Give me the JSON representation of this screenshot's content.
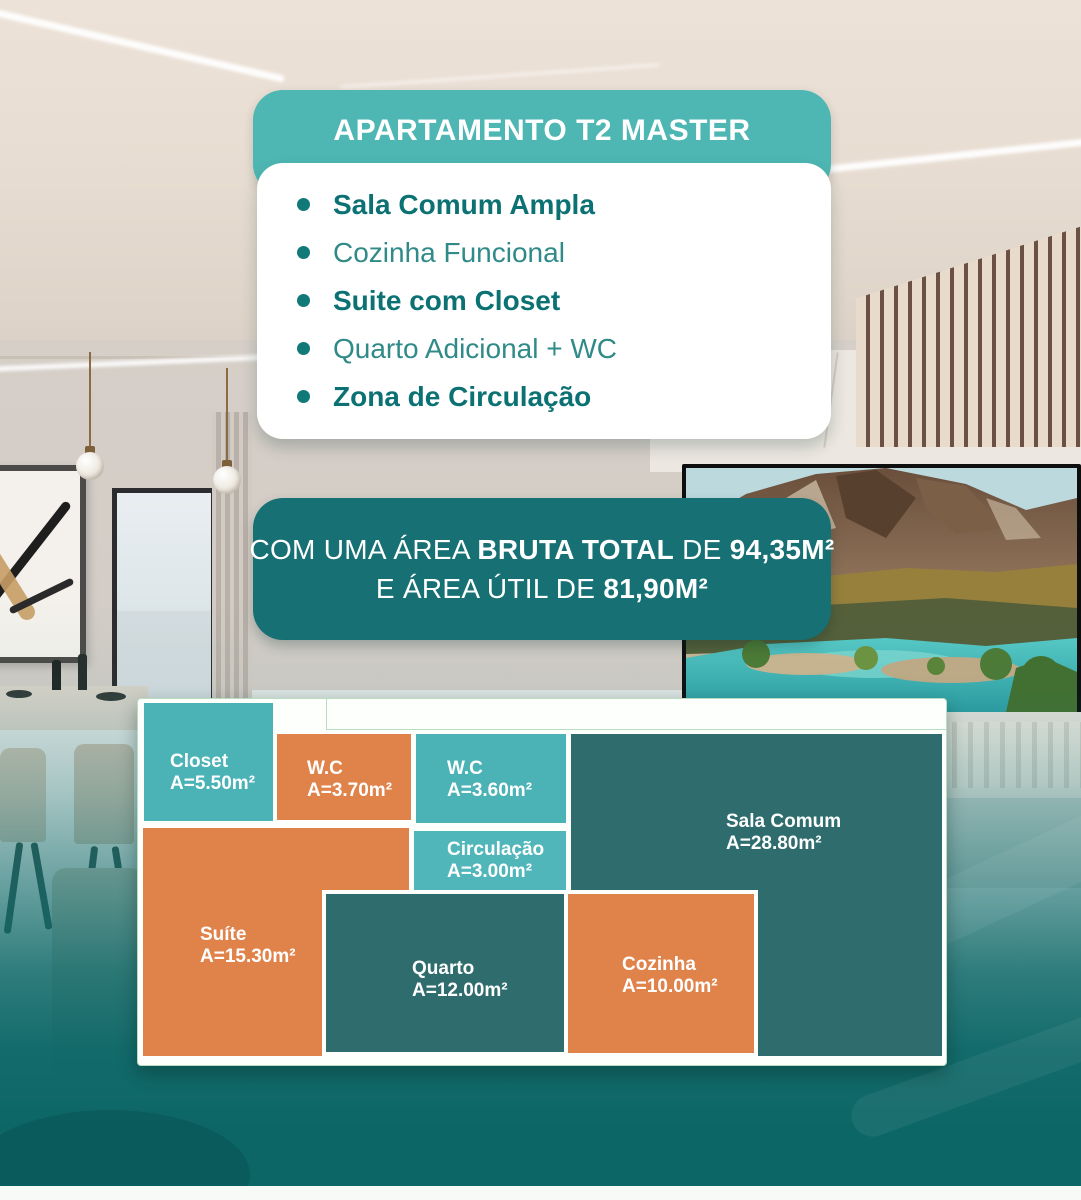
{
  "header": {
    "title": "APARTAMENTO T2 MASTER"
  },
  "features": {
    "items": [
      {
        "label": "Sala Comum Ampla",
        "emphasis": "bold"
      },
      {
        "label": "Cozinha Funcional",
        "emphasis": "regular"
      },
      {
        "label": "Suite com Closet",
        "emphasis": "bold"
      },
      {
        "label": "Quarto Adicional + WC",
        "emphasis": "regular"
      },
      {
        "label": "Zona de Circulação",
        "emphasis": "bold"
      }
    ]
  },
  "area_summary": {
    "line1": [
      {
        "text": "COM UMA ÁREA ",
        "bold": false
      },
      {
        "text": "BRUTA TOTAL",
        "bold": true
      },
      {
        "text": " DE ",
        "bold": false
      },
      {
        "text": "94,35M²",
        "bold": true
      }
    ],
    "line2": [
      {
        "text": "E ÁREA ÚTIL DE ",
        "bold": false
      },
      {
        "text": "81,90M²",
        "bold": true
      }
    ]
  },
  "floor_plan": {
    "rooms": [
      {
        "id": "closet",
        "name": "Closet",
        "area_label": "A=5.50m²",
        "area_m2": 5.5,
        "color": "#4bb2b6",
        "x": 6,
        "y": 4,
        "w": 129,
        "h": 118,
        "lx": 26,
        "ly": 48,
        "bordered": false
      },
      {
        "id": "wc-1",
        "name": "W.C",
        "area_label": "A=3.70m²",
        "area_m2": 3.7,
        "color": "#e0834b",
        "x": 139,
        "y": 35,
        "w": 134,
        "h": 86,
        "lx": 30,
        "ly": 24,
        "bordered": false
      },
      {
        "id": "wc-2",
        "name": "W.C",
        "area_label": "A=3.60m²",
        "area_m2": 3.6,
        "color": "#4bb2b6",
        "x": 278,
        "y": 35,
        "w": 150,
        "h": 89,
        "lx": 31,
        "ly": 24,
        "bordered": false
      },
      {
        "id": "circulacao",
        "name": "Circulação",
        "area_label": "A=3.00m²",
        "area_m2": 3.0,
        "color": "#50b6ba",
        "x": 276,
        "y": 132,
        "w": 152,
        "h": 59,
        "lx": 33,
        "ly": 8,
        "bordered": false
      },
      {
        "id": "sala-comum",
        "name": "Sala Comum",
        "area_label": "A=28.80m²",
        "area_m2": 28.8,
        "color": "#2e6c6d",
        "x": 433,
        "y": 35,
        "w": 371,
        "h": 322,
        "lx": 155,
        "ly": 77,
        "bordered": false
      },
      {
        "id": "suite",
        "name": "Suíte",
        "area_label": "A=15.30m²",
        "area_m2": 15.3,
        "color": "#e0834b",
        "x": 5,
        "y": 129,
        "w": 266,
        "h": 228,
        "lx": 57,
        "ly": 96,
        "bordered": false
      },
      {
        "id": "quarto",
        "name": "Quarto",
        "area_label": "A=12.00m²",
        "area_m2": 12.0,
        "color": "#2e6c6d",
        "x": 184,
        "y": 191,
        "w": 248,
        "h": 166,
        "lx": 86,
        "ly": 64,
        "bordered": true
      },
      {
        "id": "cozinha",
        "name": "Cozinha",
        "area_label": "A=10.00m²",
        "area_m2": 10.0,
        "color": "#e0834b",
        "x": 426,
        "y": 191,
        "w": 194,
        "h": 167,
        "lx": 54,
        "ly": 60,
        "bordered": true
      }
    ]
  },
  "colors": {
    "accent_teal": "#4eb7b3",
    "deep_teal_card": "#177074",
    "dark_teal_block": "#2e6c6d",
    "light_teal_block": "#4bb2b6",
    "orange_block": "#e0834b",
    "text_teal_bold": "#0c7173",
    "text_teal_regular": "#2f8a88",
    "plan_border_green": "#b9ddc1"
  }
}
